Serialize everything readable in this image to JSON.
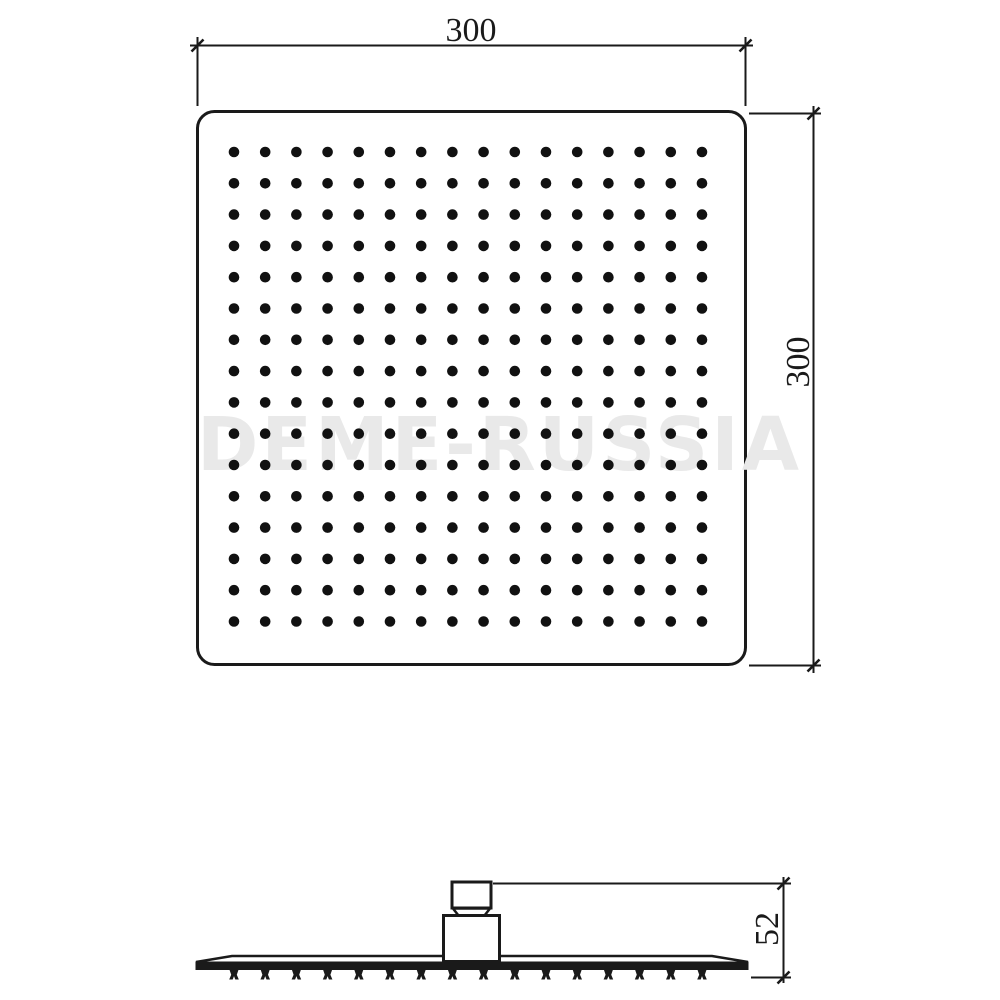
{
  "drawing": {
    "watermark": "DEME-RUSSIA",
    "top_view": {
      "width_dimension_label": "300",
      "height_dimension_label": "300",
      "nozzle_grid": {
        "rows": 16,
        "cols": 16
      }
    },
    "side_view": {
      "height_dimension_label": "52",
      "nozzle_teeth_count": 16
    },
    "colors": {
      "line": "#1a1a1a",
      "dot": "#111111",
      "watermark": "#e9e9e9",
      "background": "#ffffff"
    }
  }
}
